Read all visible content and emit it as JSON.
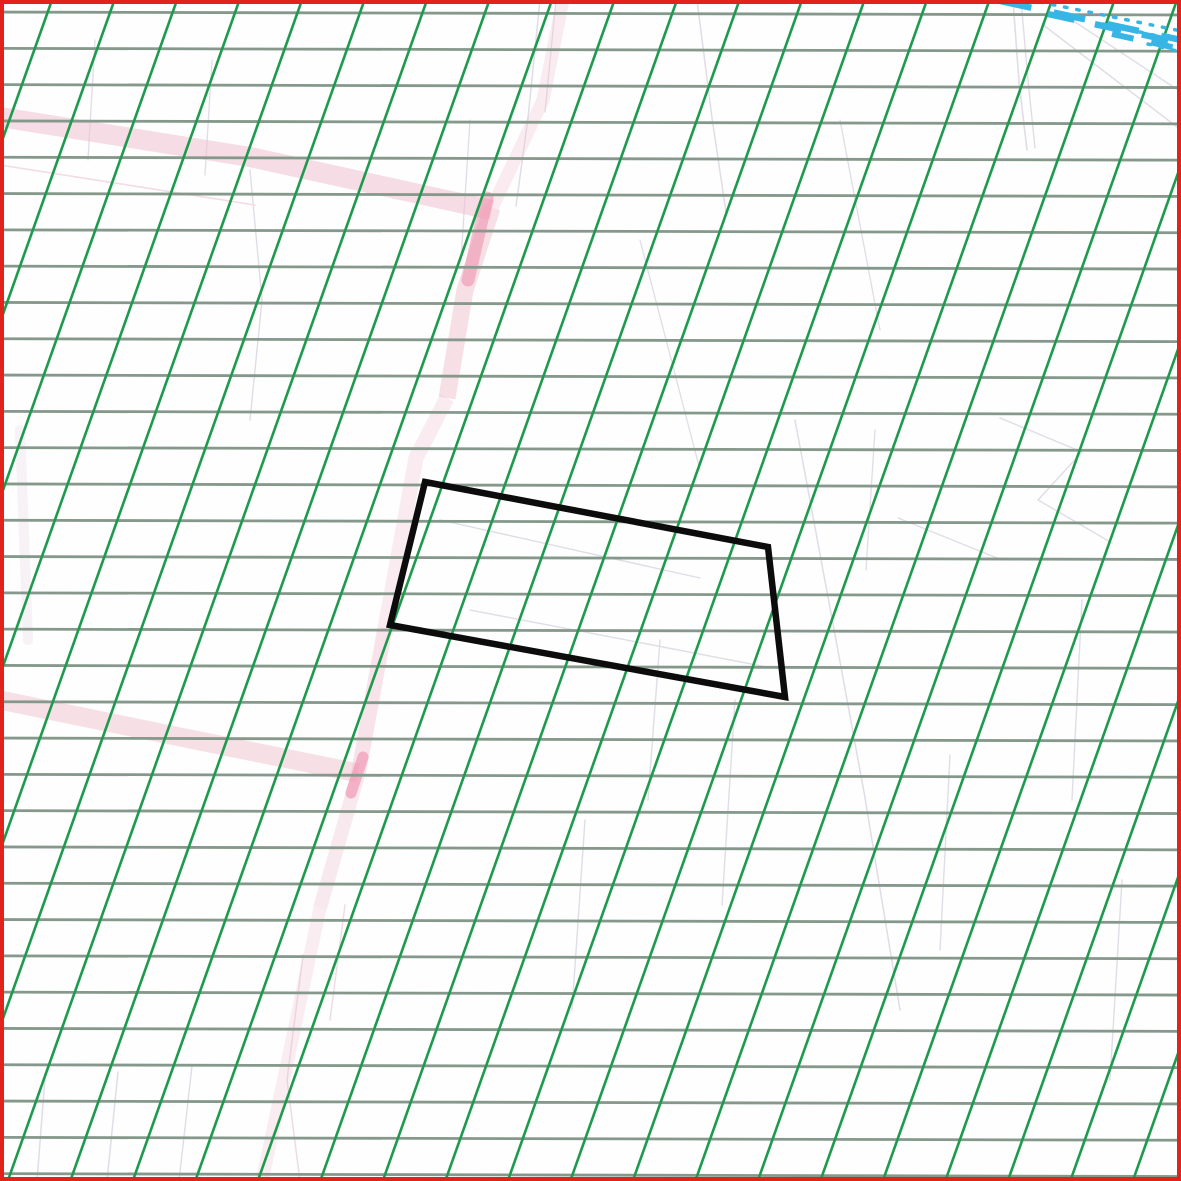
{
  "map": {
    "type": "cadastral-map-extract",
    "canvas": {
      "width": 1181,
      "height": 1181,
      "background_color": "#fdfefd"
    },
    "frame": {
      "color": "#e1231c",
      "thickness": 4
    },
    "grid": {
      "horizontal_lines": {
        "color": "#86988b",
        "stroke_width": 2.8,
        "first_y": 12,
        "count": 33,
        "spacing": 36.3,
        "right_end_drop": 3
      },
      "diagonal_lines": {
        "color": "#1e9a4e",
        "stroke_width": 2.6,
        "first_x_at_top": 52,
        "count": 27,
        "horizontal_spacing": 62.5,
        "dx_per_dy": -0.355
      }
    },
    "parcel_outline": {
      "color": "#0c0c0c",
      "stroke_width": 6.5,
      "fill": "none",
      "points": [
        [
          425,
          482
        ],
        [
          768,
          547
        ],
        [
          785,
          697
        ],
        [
          390,
          625
        ]
      ]
    },
    "roads": {
      "band_color": "#f1bfd0",
      "highlight_color": "#ee8cab",
      "segments": [
        {
          "id": "road-upper-horizontal",
          "points": [
            [
              0,
              117
            ],
            [
              250,
              157
            ],
            [
              492,
              210
            ]
          ],
          "width": 20,
          "opacity": 0.55
        },
        {
          "id": "road-vertical-upper-faint",
          "points": [
            [
              563,
              0
            ],
            [
              543,
              100
            ],
            [
              492,
              208
            ]
          ],
          "width": 13,
          "opacity": 0.3
        },
        {
          "id": "road-vertical-1",
          "points": [
            [
              492,
              208
            ],
            [
              465,
              290
            ],
            [
              447,
              398
            ]
          ],
          "width": 17,
          "opacity": 0.5
        },
        {
          "id": "road-vertical-2",
          "points": [
            [
              447,
              398
            ],
            [
              416,
              458
            ],
            [
              385,
              628
            ]
          ],
          "width": 15,
          "opacity": 0.3
        },
        {
          "id": "road-vertical-3",
          "points": [
            [
              385,
              628
            ],
            [
              358,
              775
            ]
          ],
          "width": 15,
          "opacity": 0.42
        },
        {
          "id": "road-vertical-4",
          "points": [
            [
              358,
              775
            ],
            [
              320,
              908
            ]
          ],
          "width": 14,
          "opacity": 0.33
        },
        {
          "id": "road-vertical-5",
          "points": [
            [
              320,
              908
            ],
            [
              281,
              1092
            ],
            [
              262,
              1181
            ]
          ],
          "width": 13,
          "opacity": 0.26
        },
        {
          "id": "road-lower-horizontal",
          "points": [
            [
              0,
              700
            ],
            [
              180,
              737
            ],
            [
              358,
              773
            ]
          ],
          "width": 19,
          "opacity": 0.5
        }
      ],
      "junction_highlights": [
        {
          "points": [
            [
              487,
              198
            ],
            [
              468,
              280
            ]
          ],
          "width": 13,
          "opacity": 0.55
        },
        {
          "points": [
            [
              363,
              757
            ],
            [
              351,
              793
            ]
          ],
          "width": 11,
          "opacity": 0.6
        }
      ]
    },
    "water_boundary": {
      "color": "#37b6e6",
      "dashed_lines": [
        {
          "x1": 1000,
          "y1": 1,
          "x2": 1181,
          "y2": 40,
          "width": 6.5,
          "dash": "32 23"
        },
        {
          "x1": 1048,
          "y1": 14,
          "x2": 1181,
          "y2": 43,
          "width": 6.5,
          "dash": "27 21"
        },
        {
          "x1": 1112,
          "y1": 34,
          "x2": 1181,
          "y2": 49,
          "width": 6.0,
          "dash": "22 18"
        }
      ],
      "dotted_lines": [
        {
          "x1": 1040,
          "y1": 2,
          "x2": 1181,
          "y2": 31,
          "width": 3.5,
          "dash": "2.5 10"
        },
        {
          "x1": 1103,
          "y1": 24,
          "x2": 1181,
          "y2": 41,
          "width": 3.5,
          "dash": "2.5 10"
        },
        {
          "x1": 1148,
          "y1": 44,
          "x2": 1181,
          "y2": 52,
          "width": 3.5,
          "dash": "2.5 10"
        }
      ]
    },
    "underlay_lines": {
      "default_color": "#e0dde6",
      "lines": [
        {
          "points": [
            [
              1013,
              0
            ],
            [
              1019,
              82
            ],
            [
              1027,
              150
            ]
          ],
          "width": 1.6
        },
        {
          "points": [
            [
              1021,
              0
            ],
            [
              1028,
              80
            ],
            [
              1035,
              148
            ]
          ],
          "width": 1.4
        },
        {
          "points": [
            [
              1042,
              24
            ],
            [
              1181,
              130
            ]
          ],
          "width": 1.5
        },
        {
          "points": [
            [
              1060,
              12
            ],
            [
              1181,
              92
            ]
          ],
          "width": 1.4
        },
        {
          "points": [
            [
              697,
              0
            ],
            [
              712,
              118
            ],
            [
              726,
              212
            ]
          ],
          "width": 1.5
        },
        {
          "points": [
            [
              540,
              0
            ],
            [
              528,
              118
            ],
            [
              516,
              206
            ]
          ],
          "width": 1.5
        },
        {
          "points": [
            [
              556,
              0
            ],
            [
              545,
              112
            ]
          ],
          "width": 1.3
        },
        {
          "points": [
            [
              95,
              40
            ],
            [
              88,
              160
            ]
          ],
          "width": 1.3
        },
        {
          "points": [
            [
              212,
              60
            ],
            [
              205,
              175
            ]
          ],
          "width": 1.3
        },
        {
          "points": [
            [
              470,
              120
            ],
            [
              461,
              260
            ]
          ],
          "width": 1.3
        },
        {
          "points": [
            [
              440,
              520
            ],
            [
              700,
              578
            ]
          ],
          "width": 1.4
        },
        {
          "points": [
            [
              470,
              610
            ],
            [
              762,
              666
            ]
          ],
          "width": 1.4
        },
        {
          "points": [
            [
              795,
              420
            ],
            [
              836,
              640
            ],
            [
              864,
              792
            ],
            [
              900,
              1010
            ]
          ],
          "width": 1.5
        },
        {
          "points": [
            [
              1000,
              418
            ],
            [
              1082,
              452
            ],
            [
              1038,
              500
            ],
            [
              1112,
              543
            ]
          ],
          "width": 1.4
        },
        {
          "points": [
            [
              898,
              518
            ],
            [
              1002,
              560
            ]
          ],
          "width": 1.3
        },
        {
          "points": [
            [
              875,
              430
            ],
            [
              866,
              570
            ]
          ],
          "width": 1.3
        },
        {
          "points": [
            [
              840,
              120
            ],
            [
              880,
              330
            ]
          ],
          "width": 1.3
        },
        {
          "points": [
            [
              640,
              240
            ],
            [
              700,
              470
            ]
          ],
          "width": 1.3
        },
        {
          "points": [
            [
              660,
              640
            ],
            [
              648,
              800
            ]
          ],
          "width": 1.4
        },
        {
          "points": [
            [
              735,
              700
            ],
            [
              722,
              905
            ]
          ],
          "width": 1.4
        },
        {
          "points": [
            [
              585,
              820
            ],
            [
              572,
              1010
            ]
          ],
          "width": 1.4
        },
        {
          "points": [
            [
              950,
              755
            ],
            [
              940,
              950
            ]
          ],
          "width": 1.4
        },
        {
          "points": [
            [
              1082,
              600
            ],
            [
              1072,
              800
            ]
          ],
          "width": 1.4
        },
        {
          "points": [
            [
              1122,
              880
            ],
            [
              1110,
              1080
            ]
          ],
          "width": 1.4
        },
        {
          "points": [
            [
              45,
              1078
            ],
            [
              37,
              1181
            ]
          ],
          "width": 1.5
        },
        {
          "points": [
            [
              118,
              1072
            ],
            [
              107,
              1181
            ]
          ],
          "width": 1.5
        },
        {
          "points": [
            [
              192,
              1066
            ],
            [
              179,
              1181
            ]
          ],
          "width": 1.4
        },
        {
          "points": [
            [
              250,
              170
            ],
            [
              262,
              300
            ],
            [
              250,
              420
            ]
          ],
          "width": 1.4
        },
        {
          "points": [
            [
              0,
              165
            ],
            [
              255,
              205
            ]
          ],
          "width": 1.6,
          "color": "#f3dbe4"
        },
        {
          "points": [
            [
              303,
              955
            ],
            [
              287,
              1080
            ],
            [
              300,
              1181
            ]
          ],
          "width": 1.5,
          "color": "#eedbe4"
        },
        {
          "points": [
            [
              345,
              905
            ],
            [
              330,
              1020
            ]
          ],
          "width": 1.4,
          "color": "#eedbe4"
        },
        {
          "points": [
            [
              20,
              430
            ],
            [
              28,
              640
            ]
          ],
          "width": 10,
          "color": "#f4e9f0",
          "opacity": 0.6
        }
      ]
    }
  }
}
